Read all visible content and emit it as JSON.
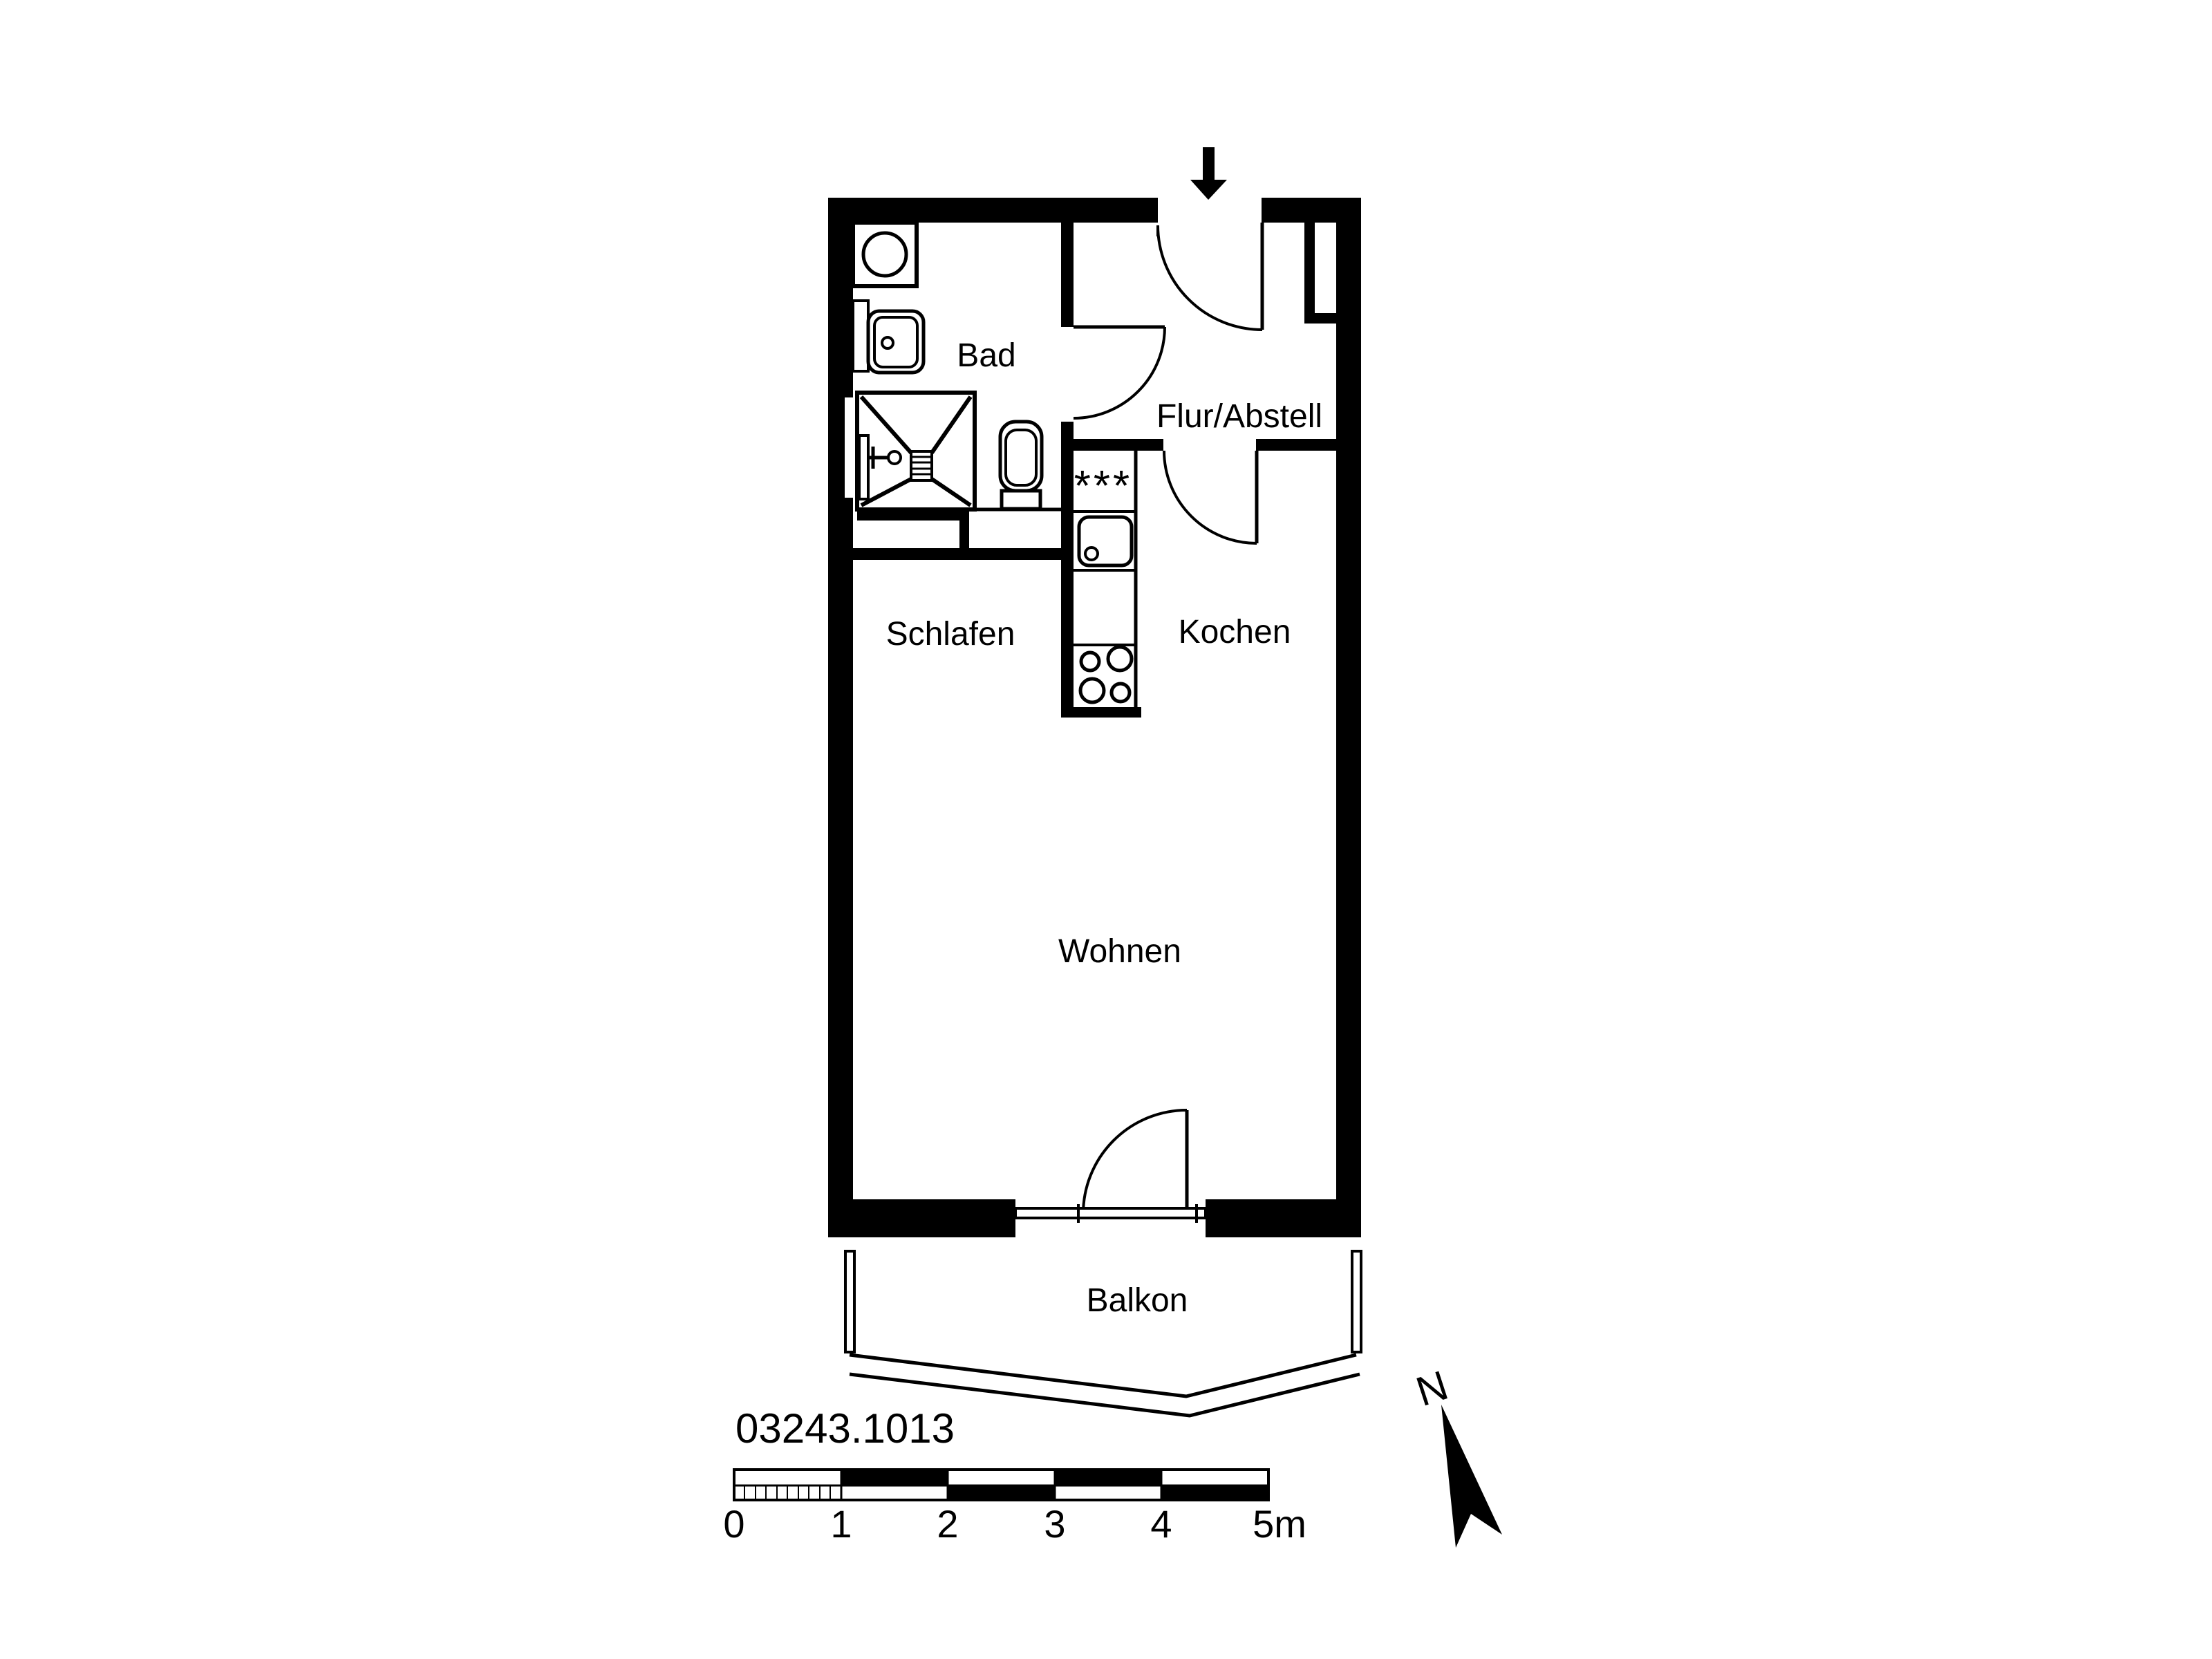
{
  "plan": {
    "plan_number": "03243.1013",
    "rooms": {
      "bad": "Bad",
      "flur_abstell": "Flur/Abstell",
      "schlafen": "Schlafen",
      "kochen": "Kochen",
      "wohnen": "Wohnen",
      "balkon": "Balkon"
    },
    "symbols": {
      "fridge_marking": "***",
      "north_label": "N"
    },
    "scale_bar": {
      "tick_labels": [
        "0",
        "1",
        "2",
        "3",
        "4",
        "5m"
      ],
      "total_meters": 5,
      "first_meter_subdivisions": 10
    },
    "colors": {
      "ink": "#000000",
      "paper": "#ffffff"
    }
  }
}
